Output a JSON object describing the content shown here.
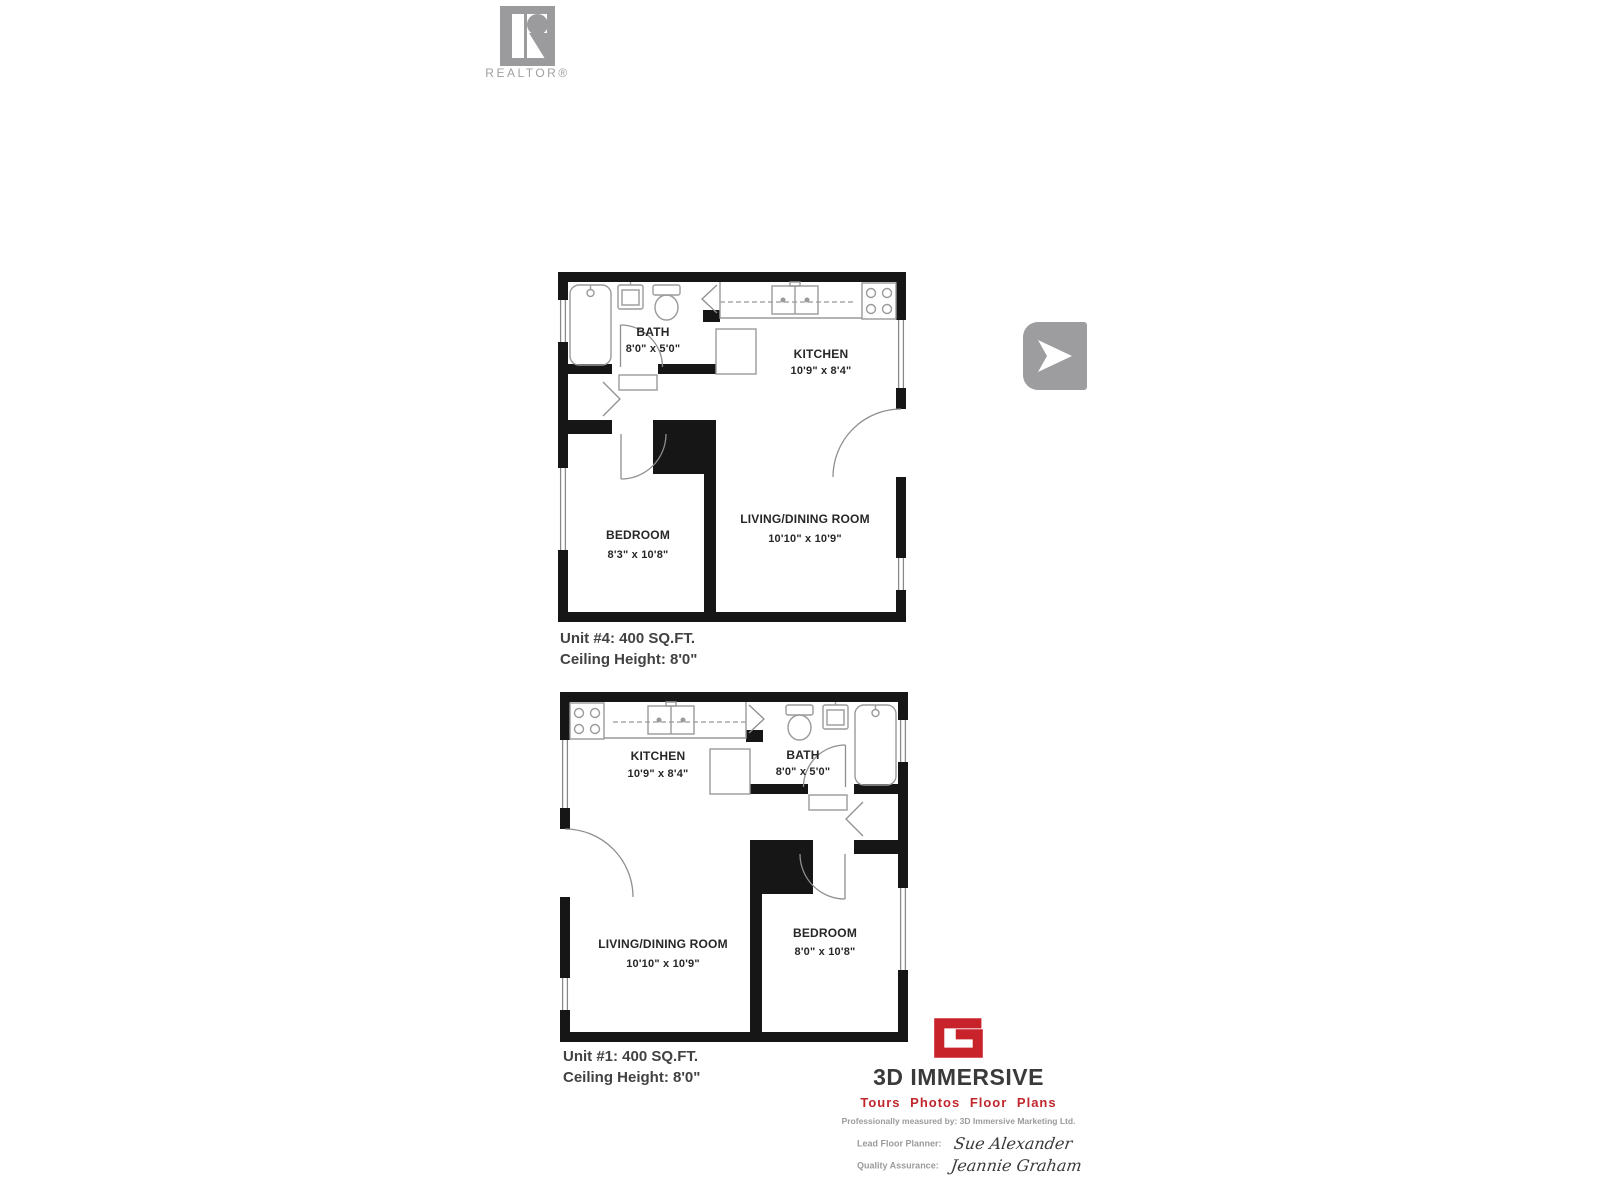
{
  "realtor": {
    "wordmark": "REALTOR®",
    "gray": "#9b9b9e"
  },
  "viewer": {
    "next_icon": "play-arrow"
  },
  "plans": [
    {
      "unit_caption": "Unit #4: 400 SQ.FT.",
      "ceiling_caption": "Ceiling Height: 8'0\"",
      "rooms": [
        {
          "name": "BATH",
          "dims": "8'0\" x 5'0\""
        },
        {
          "name": "KITCHEN",
          "dims": "10'9\" x 8'4\""
        },
        {
          "name": "BEDROOM",
          "dims": "8'3\" x 10'8\""
        },
        {
          "name": "LIVING/DINING ROOM",
          "dims": "10'10\" x 10'9\""
        }
      ]
    },
    {
      "unit_caption": "Unit #1: 400 SQ.FT.",
      "ceiling_caption": "Ceiling Height: 8'0\"",
      "rooms": [
        {
          "name": "KITCHEN",
          "dims": "10'9\" x 8'4\""
        },
        {
          "name": "BATH",
          "dims": "8'0\" x 5'0\""
        },
        {
          "name": "LIVING/DINING ROOM",
          "dims": "10'10\" x 10'9\""
        },
        {
          "name": "BEDROOM",
          "dims": "8'0\" x 10'8\""
        }
      ]
    }
  ],
  "branding": {
    "company": "3D IMMERSIVE",
    "tagline": "Tours Photos Floor Plans",
    "measured_by": "Professionally measured by: 3D Immersive Marketing Ltd.",
    "lead_label": "Lead Floor Planner:",
    "lead_name": "Sue Alexander",
    "qa_label": "Quality Assurance:",
    "qa_name": "Jeannie Graham",
    "accent_red": "#c8232b"
  },
  "colors": {
    "wall": "#161616",
    "fixture": "#9a9a9a",
    "label": "#272727",
    "caption": "#424242"
  }
}
